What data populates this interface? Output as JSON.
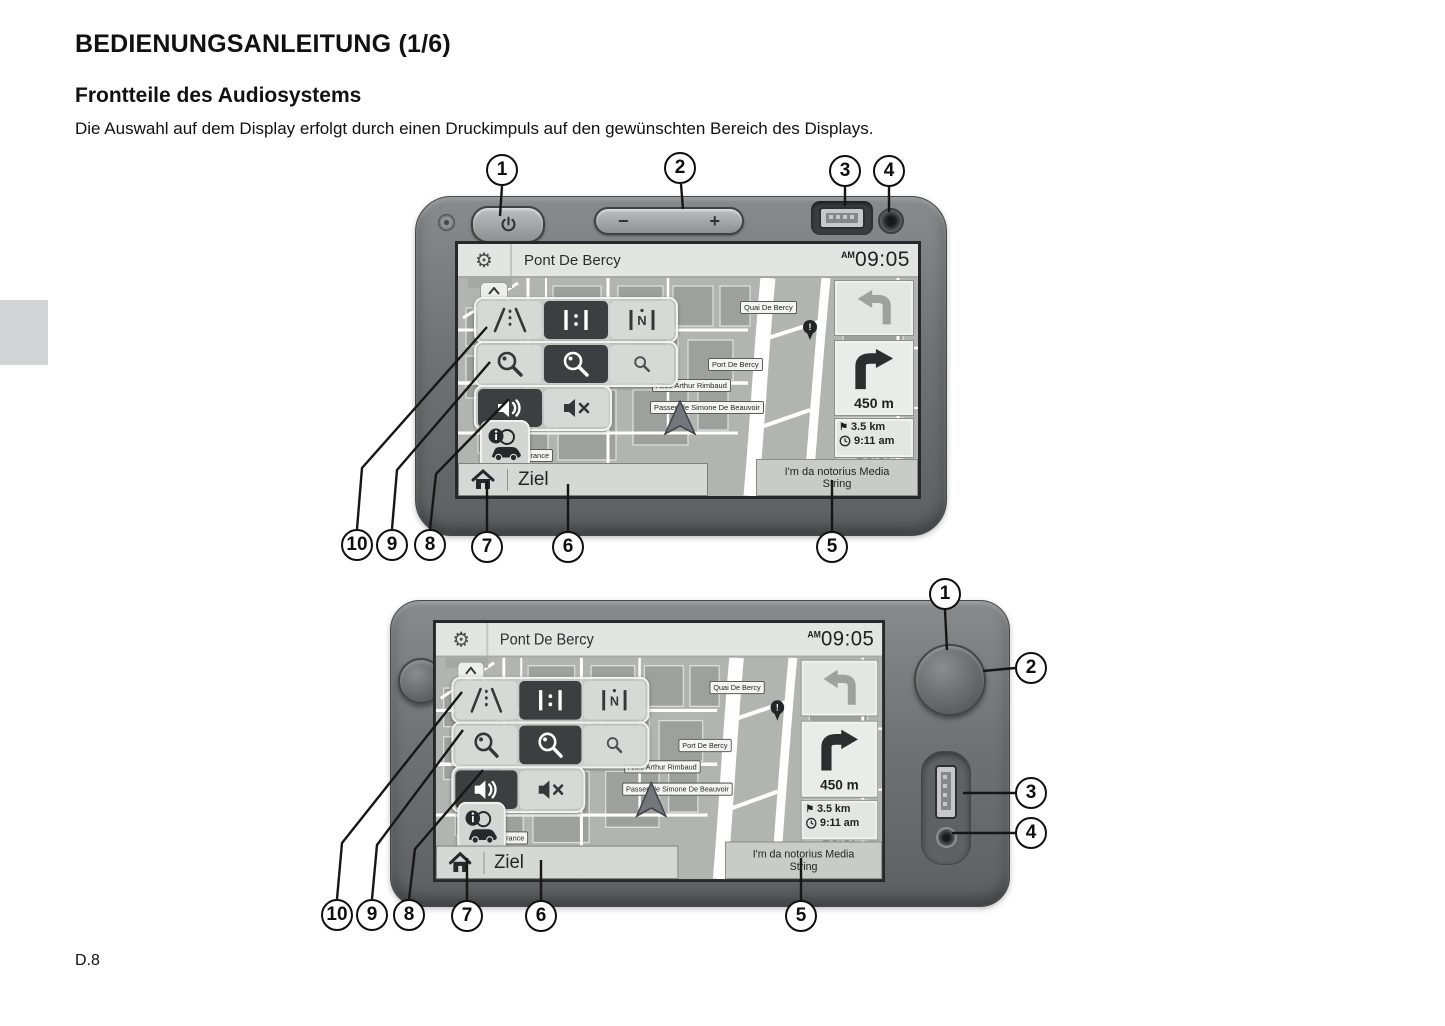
{
  "page": {
    "title": "BEDIENUNGSANLEITUNG (1/6)",
    "subtitle": "Frontteile des Audiosystems",
    "body": "Die Auswahl auf dem Display erfolgt durch einen Druckimpuls auf den gewünschten Bereich des Displays.",
    "footer": "D.8"
  },
  "device_front": {
    "volume_minus": "−",
    "volume_plus": "+"
  },
  "screen": {
    "header": {
      "title": "Pont De Bercy",
      "meridiem": "AM",
      "time": "09:05"
    },
    "view_tools": {
      "north_letter": "N"
    },
    "map": {
      "streets": {
        "quai": "Quai De Bercy",
        "port": "Port De Bercy",
        "allee": "Allée Arthur Rimbaud",
        "passerelle": "Passerelle Simone De Beauvoir",
        "avenue": "Avenue de France"
      },
      "area": "Bercy",
      "alert": "!"
    },
    "guidance": {
      "turn_distance": "450 m",
      "remaining": "3.5 km",
      "eta": "9:11 am"
    },
    "bottom": {
      "destination": "Ziel",
      "media_line1": "I'm da notorius Media",
      "media_line2": "String"
    }
  },
  "icons": {
    "gear": "⚙",
    "flag": "⚑"
  },
  "callouts": {
    "c1": "1",
    "c2": "2",
    "c3": "3",
    "c4": "4",
    "c5": "5",
    "c6": "6",
    "c7": "7",
    "c8": "8",
    "c9": "9",
    "c10": "10"
  },
  "colors": {
    "bezel": "#707375",
    "button_dark": "#3c3e40",
    "screen_header": "#e3e5e3",
    "map_bg": "#b2b4b2",
    "map_block": "#9da09d"
  }
}
